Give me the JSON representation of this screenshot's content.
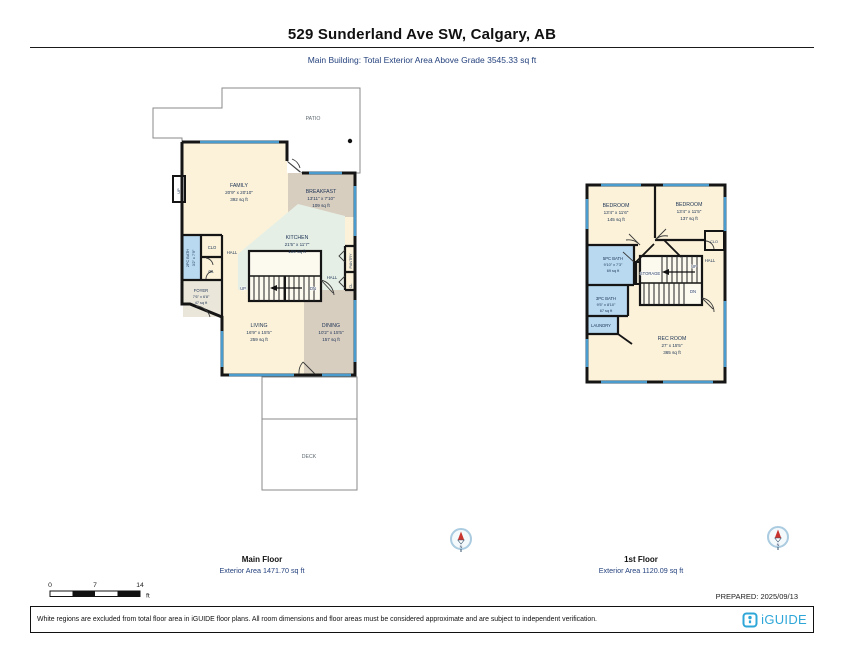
{
  "header": {
    "title": "529 Sunderland Ave SW, Calgary, AB",
    "subtitle": "Main Building: Total Exterior Area Above Grade 3545.33 sq ft"
  },
  "colors": {
    "wall": "#151515",
    "window_blue": "#4a9ccf",
    "room_cream": "#fbf2d9",
    "room_tan": "#d8cec0",
    "room_mint": "#e5efe6",
    "room_blue": "#b8d9f0",
    "brand_blue": "#2ea7d8",
    "label_navy": "#1c3254"
  },
  "main_floor": {
    "caption": "Main Floor",
    "area_caption": "Exterior Area 1471.70 sq ft",
    "patio_label": "PATIO",
    "deck_label": "DECK",
    "rooms": {
      "family": {
        "name": "FAMILY",
        "dims": "20'9\" x 20'10\"",
        "area": "392 sq ft"
      },
      "breakfast": {
        "name": "BREAKFAST",
        "dims": "13'11\" x 7'10\"",
        "area": "109 sq ft"
      },
      "kitchen": {
        "name": "KITCHEN",
        "dims": "21'5\" x 11'7\"",
        "area": "199 sq ft"
      },
      "living": {
        "name": "LIVING",
        "dims": "16'9\" x 15'5\"",
        "area": "259 sq ft"
      },
      "dining": {
        "name": "DINING",
        "dims": "10'2\" x 15'5\"",
        "area": "157 sq ft"
      },
      "foyer": {
        "name": "FOYER",
        "dims": "7'6\" x 6'8\"",
        "area": "47 sq ft"
      },
      "bath2": {
        "name": "2PC BATH",
        "dims": "3'2\" x 7'9\""
      }
    },
    "labels": {
      "hall_left": "HALL",
      "hall_right": "HALL",
      "up_stairs": "UP",
      "dn_stairs": "DN",
      "up_exterior": "UP",
      "clo": "CLO",
      "cl_left": "CL",
      "pantry": "PANTRY",
      "cl_right": "CL"
    }
  },
  "first_floor": {
    "caption": "1st Floor",
    "area_caption": "Exterior Area 1120.09 sq ft",
    "rooms": {
      "bedroom_left": {
        "name": "BEDROOM",
        "dims": "13'4\" x 11'6\"",
        "area": "145 sq ft"
      },
      "bedroom_right": {
        "name": "BEDROOM",
        "dims": "13'4\" x 11'5\"",
        "area": "137 sq ft"
      },
      "bath5": {
        "name": "5PC BATH",
        "dims": "9'10\" x 7'3\"",
        "area": "69 sq ft"
      },
      "bath3": {
        "name": "3PC BATH",
        "dims": "9'5\" x 8'10\"",
        "area": "67 sq ft"
      },
      "rec": {
        "name": "REC ROOM",
        "dims": "27' x 15'5\"",
        "area": "365 sq ft"
      }
    },
    "labels": {
      "storage": "STORAGE",
      "laundry": "LAUNDRY",
      "hall": "HALL",
      "clo": "CLO",
      "up": "UP",
      "dn": "DN"
    }
  },
  "compass": {
    "north": "N"
  },
  "scale_bar": {
    "zero": "0",
    "seven": "7",
    "fourteen": "14",
    "unit": "ft"
  },
  "prepared": "PREPARED: 2025/09/13",
  "footer": {
    "disclaimer": "White regions are excluded from total floor area in iGUIDE floor plans. All room dimensions and floor areas must be considered approximate and are subject to independent verification.",
    "brand": "iGUIDE"
  }
}
